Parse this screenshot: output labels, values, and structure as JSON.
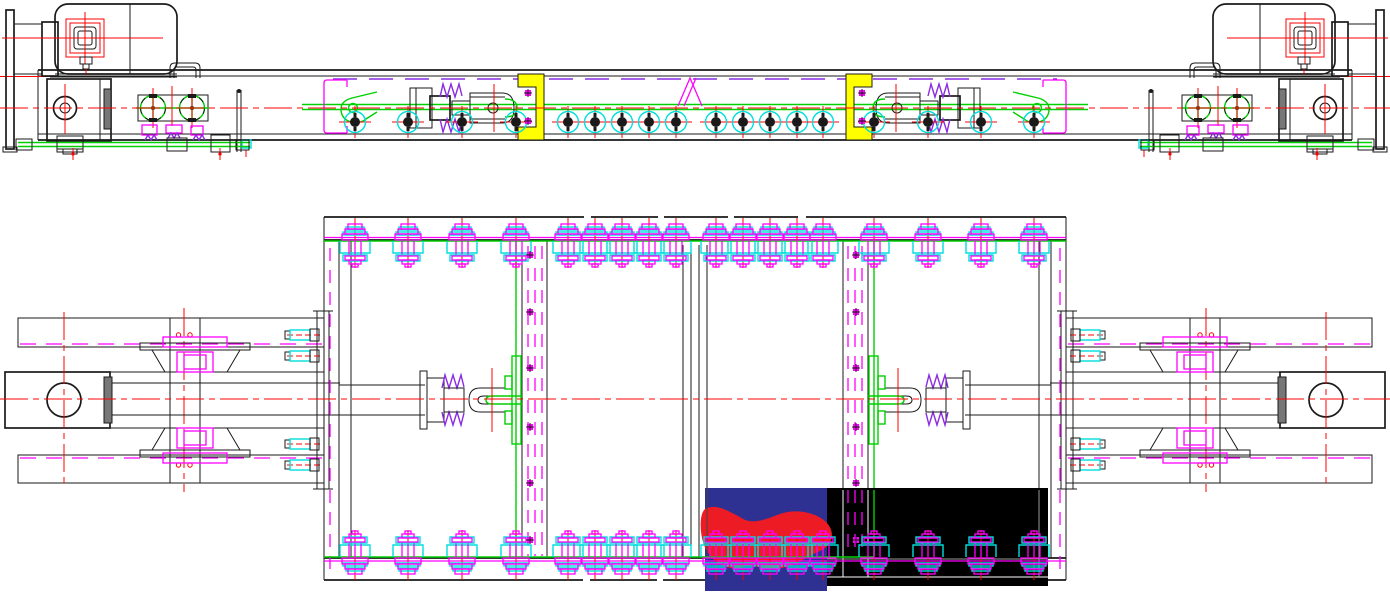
{
  "drawing": {
    "kind": "mechanical-assembly-cad-drawing",
    "views": {
      "elevation": {
        "name": "side-elevation-view"
      },
      "plan": {
        "name": "plan-view"
      }
    }
  },
  "palette": {
    "ink": "#1a1a1a",
    "red": "#ff0000",
    "green": "#00cf00",
    "cyan": "#00dede",
    "magenta": "#ff00ff",
    "violet": "#8a2be2",
    "yellow": "#ffff00",
    "navy": "#2e3192",
    "crimson": "#ed1c24",
    "gray": "#9a9a9a"
  },
  "fasteners": {
    "bolt_xs": [
      355,
      408,
      462,
      516,
      568,
      595,
      622,
      649,
      676,
      716,
      743,
      770,
      797,
      823,
      874,
      928,
      981,
      1034
    ],
    "elevation_bolt_y": 122,
    "plan_top_flange_y": 240,
    "plan_bottom_flange_y": 558,
    "rivet_column_xs": [
      530,
      856
    ],
    "rivet_ys": [
      255,
      312,
      368,
      427,
      483,
      540
    ],
    "channel_rivet_xs": [
      528,
      862
    ],
    "channel_rivet_ys": [
      93,
      121
    ],
    "side_bolt_ys": [
      335,
      356,
      444,
      465
    ]
  },
  "overlays": {
    "navy_block": {
      "x": 705,
      "y": 488,
      "w": 122,
      "h": 103
    },
    "black_block": {
      "x": 827,
      "y": 488,
      "w": 221,
      "h": 98
    }
  }
}
